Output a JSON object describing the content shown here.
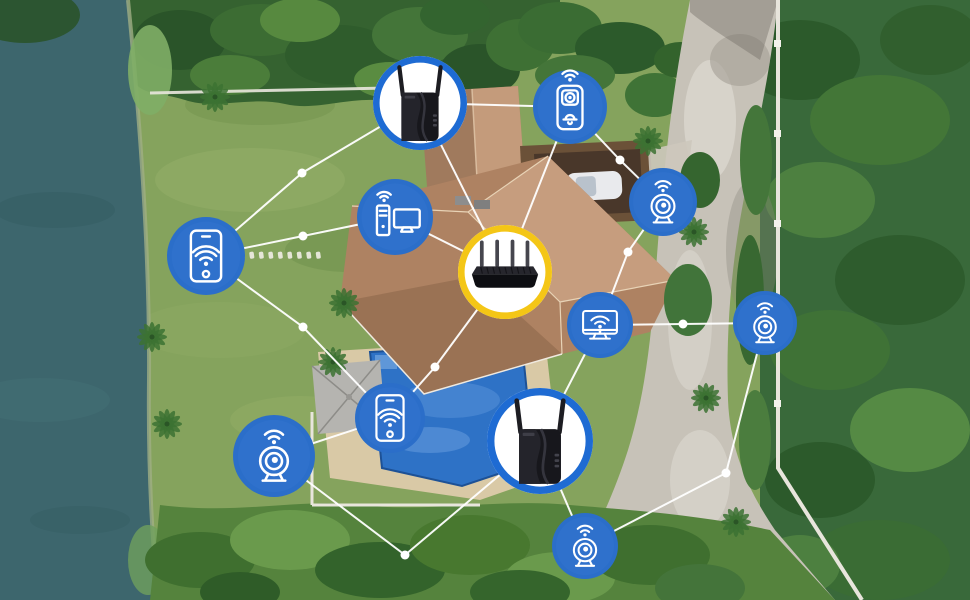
{
  "colors": {
    "icon_circle_blue": "#2b6ec9",
    "extender_ring_blue": "#1e6bd3",
    "router_ring_yellow": "#f4c616",
    "connection_line": "#ffffff"
  },
  "network": {
    "line_color": "#ffffff",
    "line_width": 2,
    "node_dot_radius": 4.5,
    "devices": [
      {
        "id": "extender-top",
        "name": "wifi-extender-top",
        "kind": "photo-extender",
        "label": "Wi-Fi range extender",
        "x": 420,
        "y": 103,
        "r": 47,
        "ring": "#1e6bd3",
        "fill": "#ffffff"
      },
      {
        "id": "router",
        "name": "wifi-router",
        "kind": "photo-router",
        "label": "Wi-Fi router",
        "x": 505,
        "y": 272,
        "r": 47,
        "ring": "#f4c616",
        "fill": "#ffffff"
      },
      {
        "id": "extender-bottom",
        "name": "wifi-extender-bottom",
        "kind": "photo-extender",
        "label": "Wi-Fi range extender",
        "x": 540,
        "y": 441,
        "r": 53,
        "ring": "#1e6bd3",
        "fill": "#ffffff"
      },
      {
        "id": "phone-left",
        "name": "smartphone-left",
        "kind": "phone-wifi",
        "label": "Smartphone",
        "x": 206,
        "y": 256,
        "r": 39,
        "fill": "#2b6ec9"
      },
      {
        "id": "camera-left",
        "name": "security-camera-left",
        "kind": "camera-wifi",
        "label": "Security camera",
        "x": 274,
        "y": 456,
        "r": 41,
        "fill": "#2b6ec9"
      },
      {
        "id": "computer",
        "name": "desktop-computer",
        "kind": "desktop-wifi",
        "label": "Desktop computer",
        "x": 395,
        "y": 217,
        "r": 38,
        "fill": "#2b6ec9"
      },
      {
        "id": "phone-pool",
        "name": "smartphone-poolside",
        "kind": "phone-wifi",
        "label": "Smartphone",
        "x": 390,
        "y": 418,
        "r": 35,
        "fill": "#2b6ec9"
      },
      {
        "id": "doorbell",
        "name": "video-doorbell",
        "kind": "doorbell-wifi",
        "label": "Video doorbell",
        "x": 570,
        "y": 107,
        "r": 37,
        "fill": "#2b6ec9"
      },
      {
        "id": "camera-topright",
        "name": "security-camera-top-right",
        "kind": "camera-wifi",
        "label": "Security camera",
        "x": 663,
        "y": 202,
        "r": 34,
        "fill": "#2b6ec9"
      },
      {
        "id": "monitor",
        "name": "smart-tv-monitor",
        "kind": "monitor-wifi",
        "label": "Smart TV",
        "x": 600,
        "y": 325,
        "r": 33,
        "fill": "#2b6ec9"
      },
      {
        "id": "camera-right",
        "name": "security-camera-right",
        "kind": "camera-wifi",
        "label": "Security camera",
        "x": 765,
        "y": 323,
        "r": 32,
        "fill": "#2b6ec9"
      },
      {
        "id": "camera-bottom",
        "name": "security-camera-bottom",
        "kind": "camera-wifi",
        "label": "Security camera",
        "x": 585,
        "y": 546,
        "r": 33,
        "fill": "#2b6ec9"
      }
    ],
    "links": [
      {
        "from": "phone-left",
        "via": [
          [
            302,
            173
          ]
        ],
        "to": "extender-top"
      },
      {
        "from": "phone-left",
        "via": [
          [
            303,
            236
          ]
        ],
        "to": "computer"
      },
      {
        "from": "phone-left",
        "via": [
          [
            303,
            327
          ]
        ],
        "to": "phone-pool"
      },
      {
        "from": "computer",
        "via": [],
        "to": "router"
      },
      {
        "from": "extender-top",
        "via": [],
        "to": "router"
      },
      {
        "from": "extender-top",
        "via": [],
        "to": "doorbell"
      },
      {
        "from": "doorbell",
        "via": [],
        "to": "router"
      },
      {
        "from": "doorbell",
        "via": [
          [
            620,
            160
          ]
        ],
        "to": "camera-topright"
      },
      {
        "from": "camera-topright",
        "via": [
          [
            628,
            252
          ]
        ],
        "to": "monitor"
      },
      {
        "from": "monitor",
        "via": [
          [
            683,
            324
          ]
        ],
        "to": "camera-right"
      },
      {
        "from": "camera-right",
        "via": [
          [
            726,
            473
          ]
        ],
        "to": "camera-bottom"
      },
      {
        "from": "extender-bottom",
        "via": [],
        "to": "camera-bottom"
      },
      {
        "from": "camera-left",
        "via": [
          [
            405,
            555
          ]
        ],
        "to": "extender-bottom"
      },
      {
        "from": "camera-left",
        "via": [],
        "to": "phone-pool"
      },
      {
        "from": "phone-pool",
        "via": [
          [
            435,
            367
          ]
        ],
        "to": "router"
      },
      {
        "from": "monitor",
        "via": [],
        "to": "extender-bottom"
      }
    ],
    "junction_dots": [
      [
        302,
        173
      ],
      [
        303,
        236
      ],
      [
        303,
        327
      ],
      [
        620,
        160
      ],
      [
        628,
        252
      ],
      [
        683,
        324
      ],
      [
        726,
        473
      ],
      [
        405,
        555
      ],
      [
        435,
        367
      ]
    ]
  }
}
